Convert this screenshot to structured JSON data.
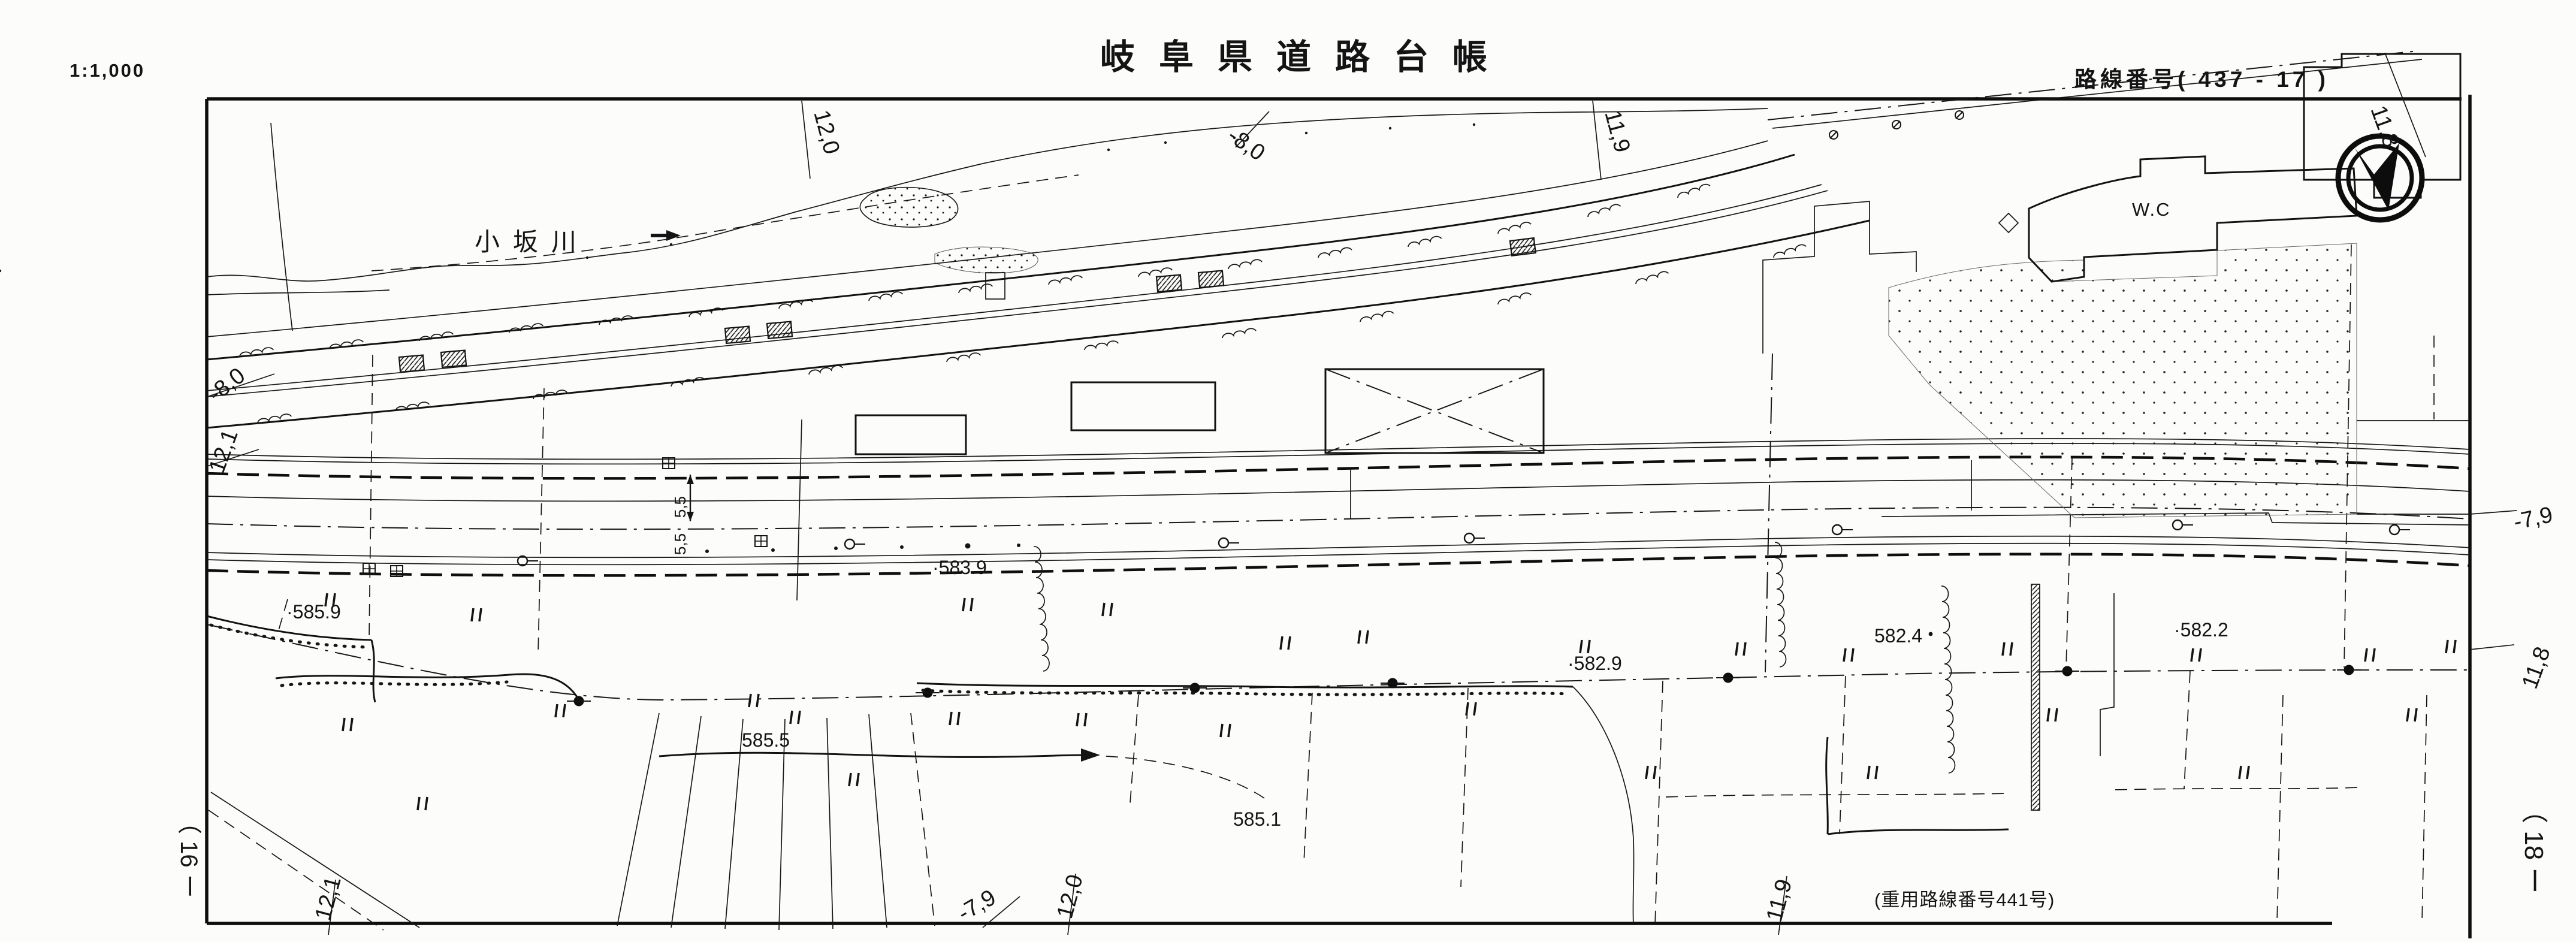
{
  "header": {
    "scale": "1:1,000",
    "title": "岐阜県道路台帳",
    "route": "路線番号( 437 - 17 )"
  },
  "map": {
    "river_name": "小坂川",
    "building_label": "W.C",
    "reuse_note": "(重用路線番号441号)",
    "sheet_ref_left": "（ 16 ー",
    "sheet_ref_right": "（ 18 ー",
    "spot_elevations": [
      "·585.9",
      "·583.9",
      "585.5",
      "585.1",
      "·582.9",
      "582.4",
      "·582.2"
    ],
    "grade_ticks": {
      "top": [
        "12,0",
        "-8,0",
        "11,9",
        "11,8"
      ],
      "bottom": [
        "12,1",
        "-7,9",
        "12,0",
        "11,9"
      ],
      "left": [
        "-8,0",
        "12,1"
      ],
      "right": [
        "-7,9",
        "11,8"
      ]
    },
    "road_width_labels": [
      "5,5",
      "5,5"
    ],
    "colors": {
      "ink": "#141414",
      "paper": "#fcfcfa"
    }
  }
}
